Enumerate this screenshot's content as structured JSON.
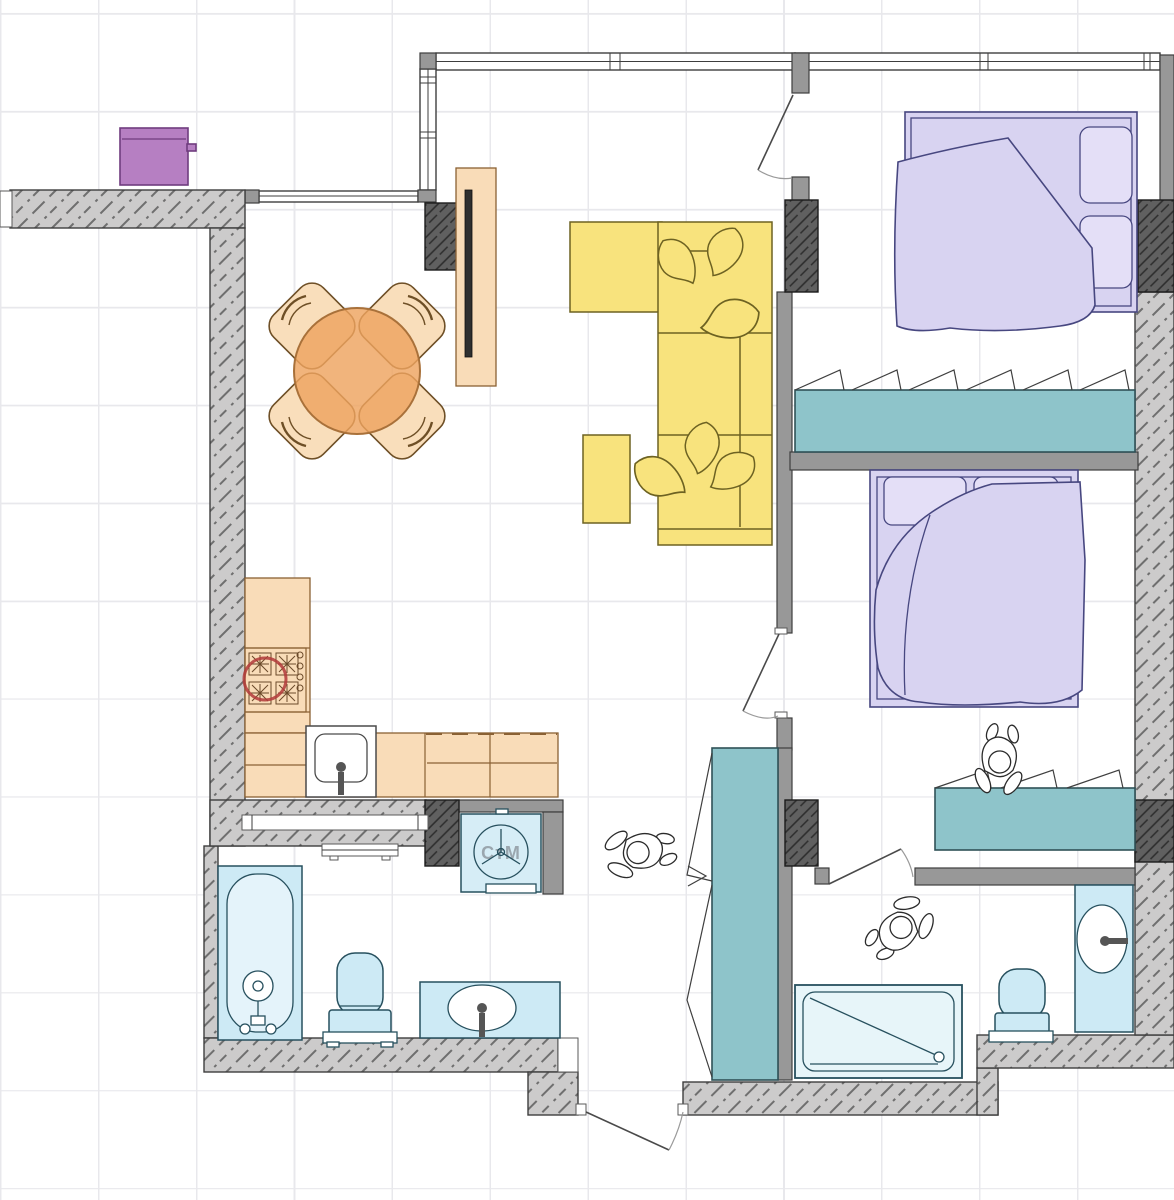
{
  "title": "apartment-floor-plan",
  "labels": {
    "washing_machine": "СтМ"
  },
  "colors": {
    "grid_line": "#e8e8ec",
    "wall_fill": "#cccbcb",
    "wall_stroke": "#3e3e3e",
    "wall_hatch": "#6f6f6f",
    "pillar_fill": "#606060",
    "pillar_hatch": "#2d2d2d",
    "wall_plain": "#989898",
    "kitchen_fill": "#f9dcb8",
    "kitchen_stroke": "#8a6134",
    "table_fill": "#eea45f",
    "chair_fill": "#f9debb",
    "chair_stroke": "#6e4f26",
    "sofa_fill": "#f8e37d",
    "sofa_stroke": "#6d6222",
    "bed_fill": "#d8d3f1",
    "pillow_fill": "#e4dff7",
    "bed_stroke": "#474780",
    "closet_fill": "#8ec4ca",
    "closet_stroke": "#2f5157",
    "fixture_fill": "#cdeaf5",
    "fixture_stroke": "#27505e",
    "shower_fill": "#e7f5f9",
    "box_fill": "#b67fc2",
    "box_stroke": "#6f3c7e",
    "appliance_text": "#9aa6ae",
    "tv_color": "#2f2f2f",
    "accent_red": "#b23a3a"
  },
  "plan": {
    "balcony": {
      "items": [
        "storage-box"
      ]
    },
    "kitchen_living_room": {
      "items": [
        "dining-table",
        "dining-chairs-x4",
        "tv-stand",
        "tv",
        "corner-sofa",
        "sofa-pillows",
        "pouf",
        "kitchen-counter",
        "gas-stove",
        "kitchen-sink"
      ]
    },
    "bedroom_1": {
      "items": [
        "double-bed",
        "wardrobe"
      ]
    },
    "bedroom_2": {
      "items": [
        "double-bed",
        "dresser",
        "person-figure"
      ]
    },
    "hallway": {
      "items": [
        "bifold-closet",
        "washing-machine",
        "person-figure",
        "entrance-door"
      ]
    },
    "bathroom_1": {
      "items": [
        "bathtub",
        "toilet",
        "vanity-sink",
        "towel-radiator",
        "pocket-door"
      ]
    },
    "bathroom_2": {
      "items": [
        "shower-tray",
        "toilet",
        "vanity-sink"
      ]
    }
  }
}
